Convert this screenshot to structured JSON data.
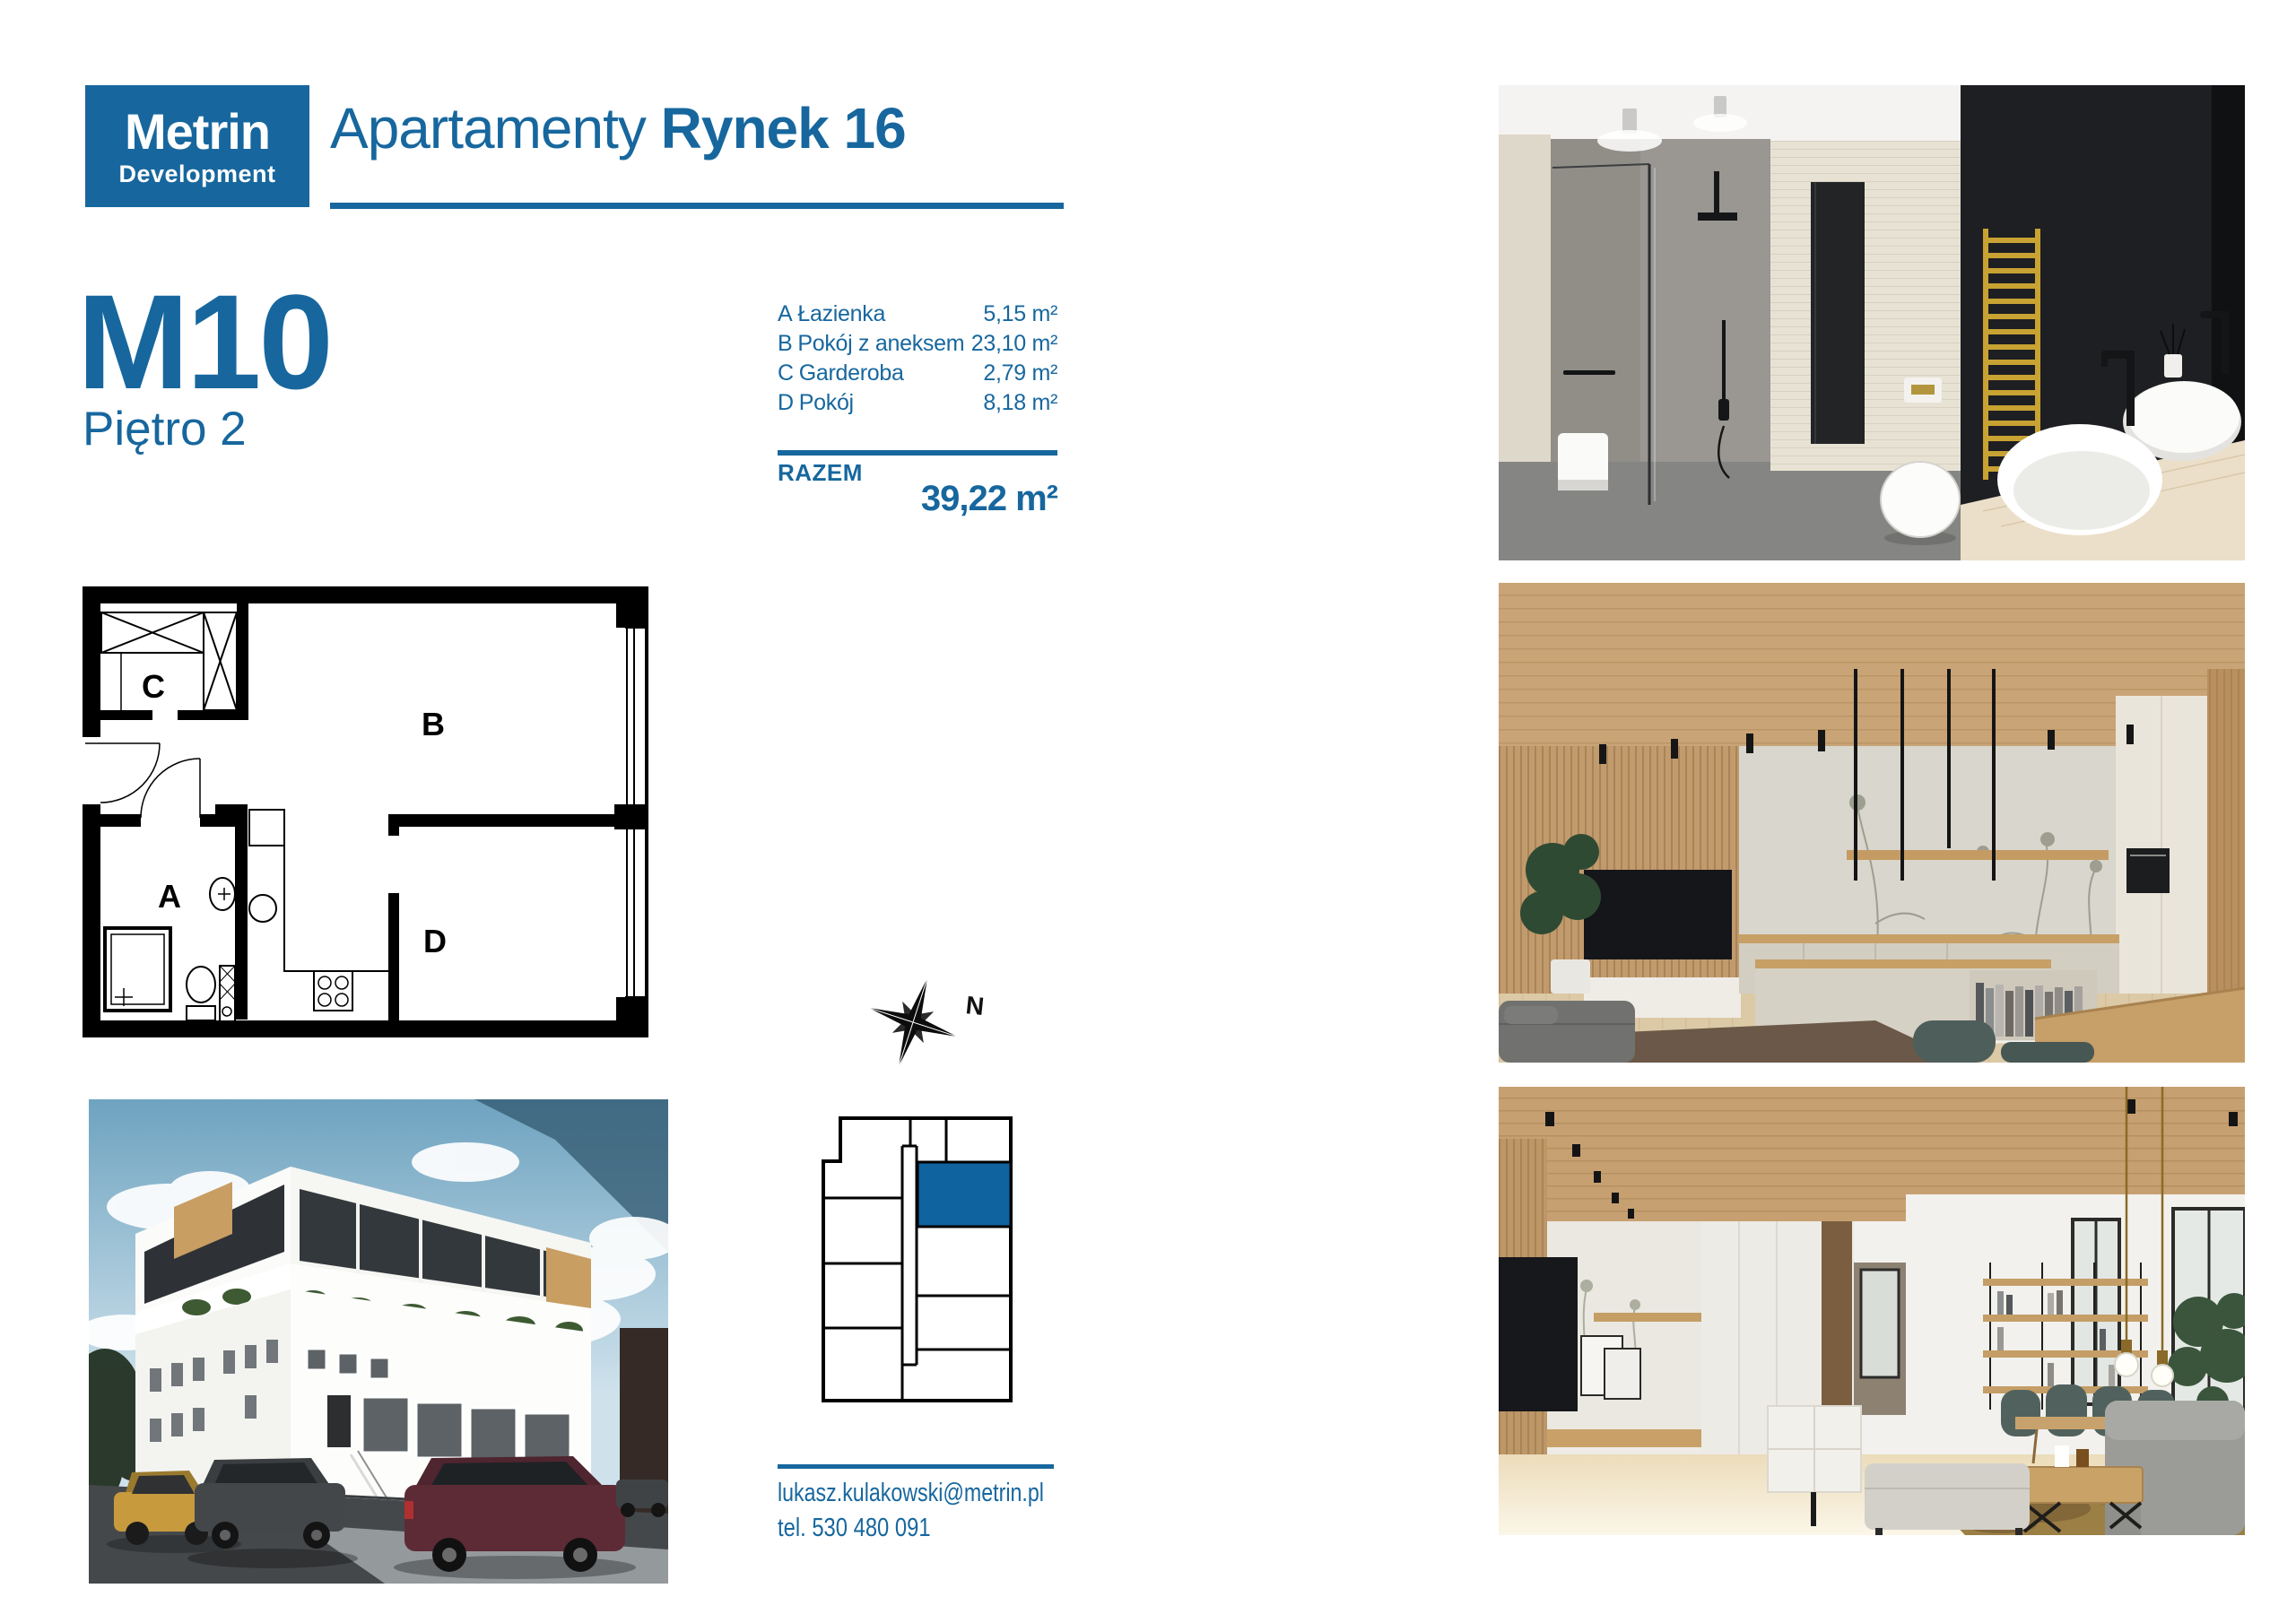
{
  "brand": {
    "logo_line1": "Metrin",
    "logo_line2": "Development",
    "accent_color": "#17679e"
  },
  "header": {
    "title_regular": "Apartamenty",
    "title_bold": "Rynek 16"
  },
  "unit": {
    "code": "M10",
    "floor_label": "Piętro 2"
  },
  "rooms": {
    "items": [
      {
        "letter": "A",
        "name": "Łazienka",
        "area": "5,15 m²"
      },
      {
        "letter": "B",
        "name": "Pokój z aneksem",
        "area": "23,10 m²"
      },
      {
        "letter": "C",
        "name": "Garderoba",
        "area": "2,79 m²"
      },
      {
        "letter": "D",
        "name": "Pokój",
        "area": "8,18 m²"
      }
    ],
    "total_label": "RAZEM",
    "total_area": "39,22 m²"
  },
  "floorplan": {
    "labels": {
      "a": "A",
      "b": "B",
      "c": "C",
      "d": "D"
    }
  },
  "compass": {
    "label": "N",
    "icon": "compass-rose-icon"
  },
  "location_diagram": {
    "highlight_color": "#0f639e",
    "highlighted_unit": "M10"
  },
  "contact": {
    "email": "lukasz.kulakowski@metrin.pl",
    "phone": "tel. 530 480 091"
  },
  "photos": {
    "top_right": "bathroom-interior-render",
    "middle_right": "kitchen-living-interior-render",
    "bottom_right": "living-room-interior-render",
    "bottom_left": "building-exterior-render"
  }
}
